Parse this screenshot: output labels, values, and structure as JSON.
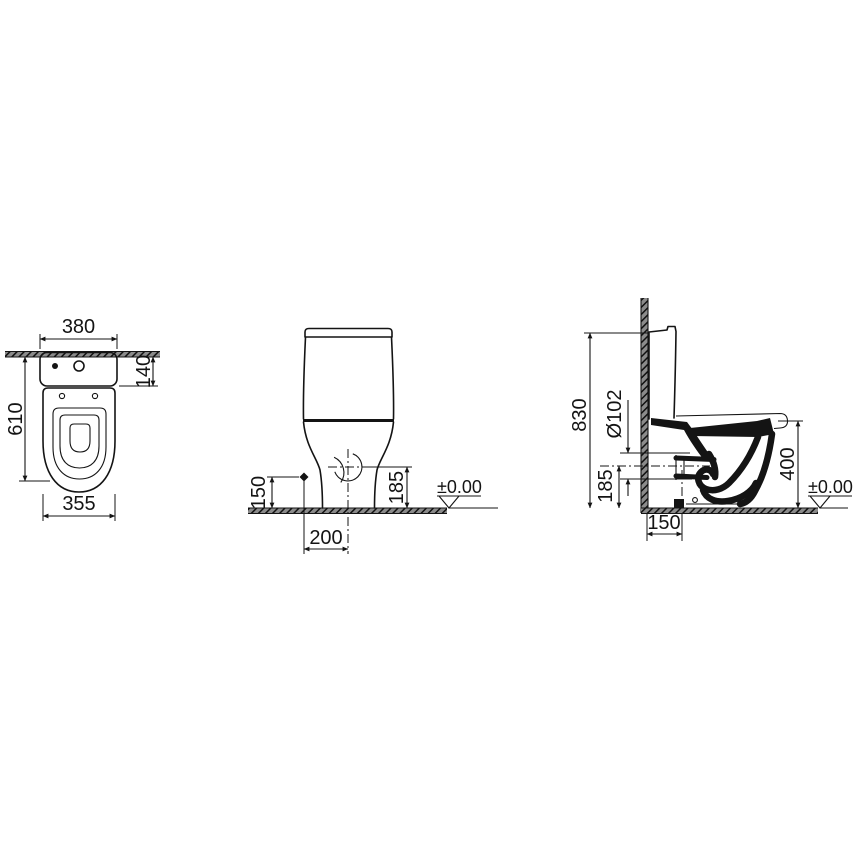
{
  "drawing": {
    "plan": {
      "width_top": "380",
      "cistern_depth": "140",
      "total_depth": "610",
      "bowl_width": "355"
    },
    "front": {
      "inlet_height": "150",
      "trap_height": "185",
      "outlet_offset": "200",
      "datum_level": "±0.00"
    },
    "side": {
      "total_height": "830",
      "outlet_diameter": "Ø102",
      "trap_height": "185",
      "rim_height": "400",
      "outlet_wall_distance": "150",
      "datum_level": "±0.00"
    }
  }
}
